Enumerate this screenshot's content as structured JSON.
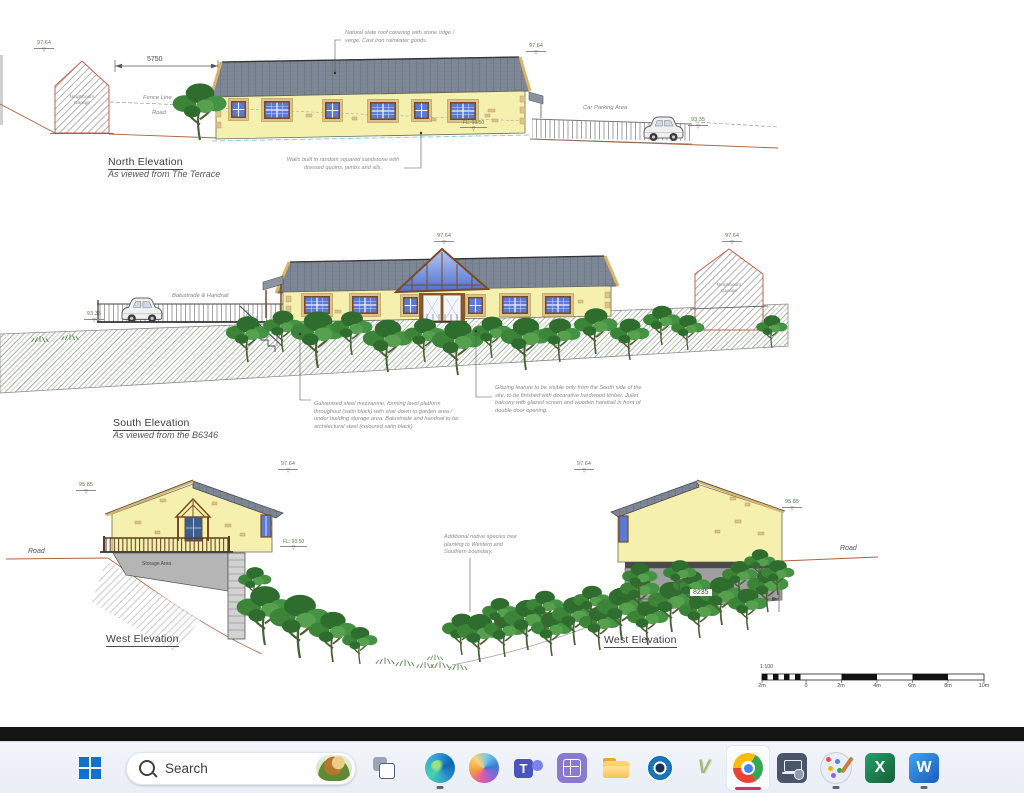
{
  "sheet": {
    "datum_symbol": "▽",
    "north": {
      "title": "North Elevation",
      "subtitle": "As viewed from The Terrace",
      "roof_note": "Natural slate roof covering with stone ridge / verge. Cast iron rainwater goods.",
      "walls_note": "Walls built in random squared sandstone with dressed quoins, jambs and sils.",
      "dim_width": "5750",
      "garage_label": "Neighbours Garage",
      "fence_label": "Fence Line",
      "road_label": "Road",
      "parking_label": "Car Parking Area",
      "datum_left": "97.64",
      "datum_ridge": "97.64",
      "datum_parking": "93.35",
      "floor_level": "FL: 93.50"
    },
    "south": {
      "title": "South Elevation",
      "subtitle": "As viewed from the B6346",
      "mezzanine_note": "Galvanised steel mezzanine, forming level platform throughout (satin black) with stair down to garden area / under building storage area. Balustrade and handrail to be architectural steel (coloured satin black).",
      "glazing_note": "Glazing feature to be visible only from the South side of the site, to be finished with decorative hardwood timber. Juliet balcony with glazed screen and wooden handrail in front of double door opening.",
      "balustrade_label": "Balustrade & Handrail",
      "garage_label": "Neighbours Garage",
      "datum_ridge": "97.64",
      "datum_garage": "97.64",
      "datum_deck": "93.35"
    },
    "west_left": {
      "title": "West Elevation",
      "storage_label": "Storage Area",
      "road_label": "Road",
      "datum_eaves": "95.85",
      "datum_ridge": "97.64",
      "floor_level": "FL: 93.50"
    },
    "west_right": {
      "title": "West Elevation",
      "planting_note": "Additional native species tree planting to Western and Southern boundary.",
      "road_label": "Road",
      "datum_ridge": "97.64",
      "datum_eaves": "95.85",
      "dim_width": "8235"
    },
    "scalebar": {
      "ratio": "1:100",
      "ticks": [
        "2m",
        "0",
        "2m",
        "4m",
        "6m",
        "8m",
        "10m"
      ]
    }
  },
  "taskbar": {
    "search_label": "Search",
    "teams_glyph": "T",
    "v_glyph": "V",
    "excel_glyph": "X",
    "word_glyph": "W"
  }
}
